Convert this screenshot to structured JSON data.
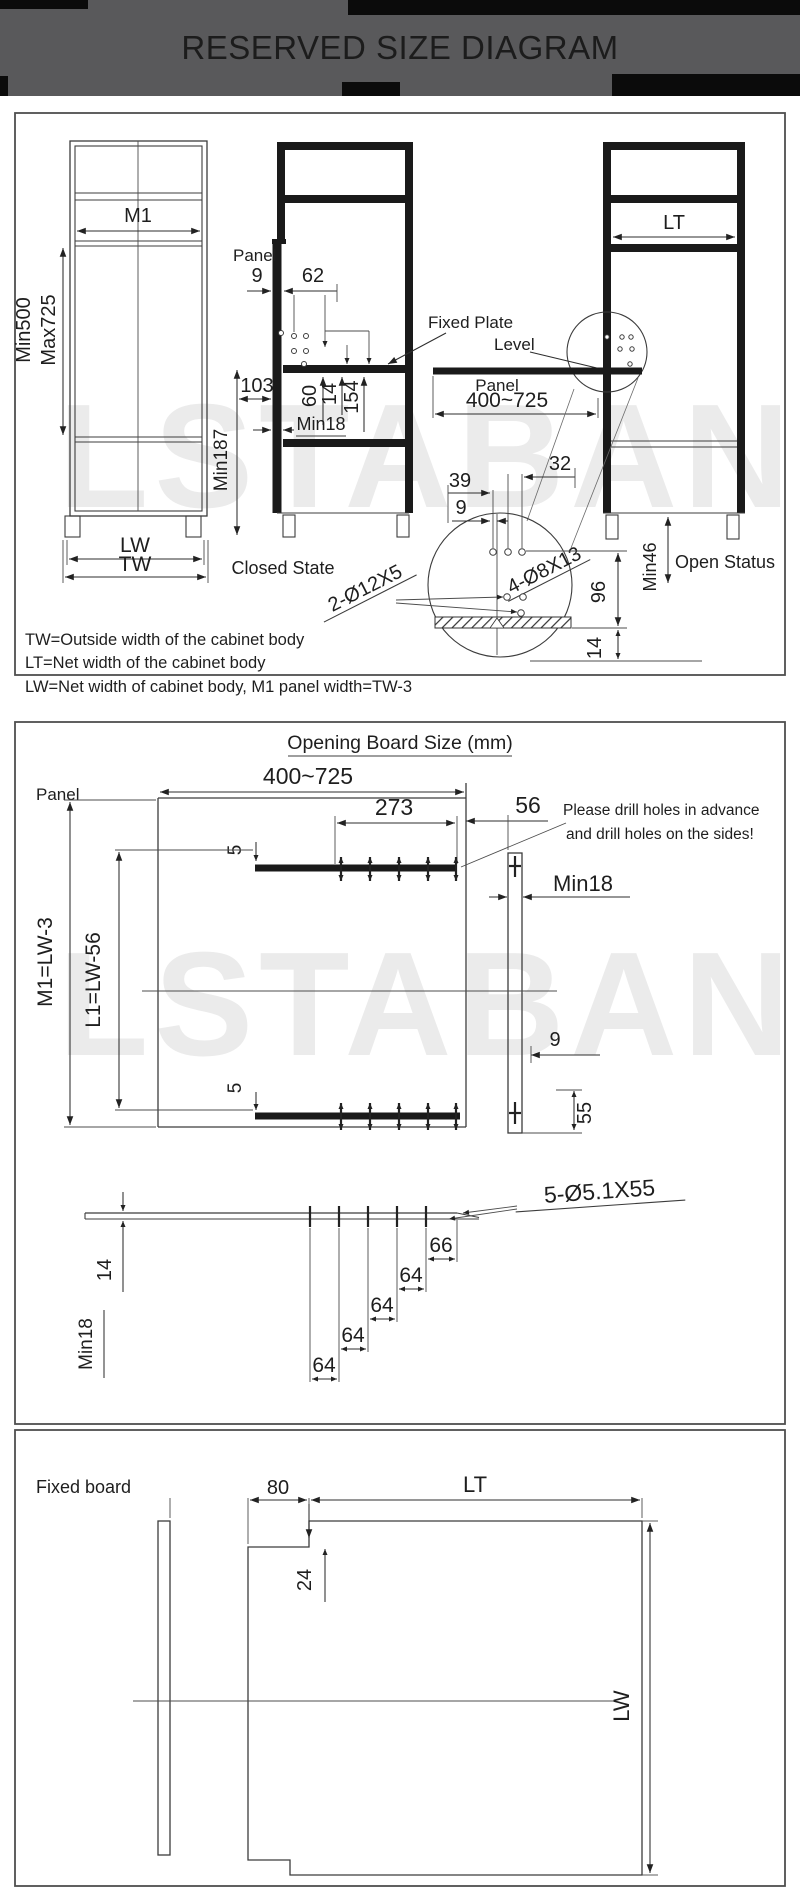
{
  "header": {
    "title": "RESERVED SIZE DIAGRAM"
  },
  "watermark": {
    "text": "LSTABAN"
  },
  "section1": {
    "m1": "M1",
    "min500": "Min500",
    "max725": "Max725",
    "panel_label": "Panel",
    "d9": "9",
    "d62": "62",
    "fixed_plate": "Fixed Plate",
    "level": "Level",
    "d103": "103",
    "d60": "60",
    "d14": "14",
    "d154": "154",
    "min18": "Min18",
    "min187": "Min187",
    "lw": "LW",
    "tw": "TW",
    "closed_state": "Closed State",
    "open_status": "Open Status",
    "lt": "LT",
    "panel2": "Panel",
    "range": "400~725",
    "d32": "32",
    "d39": "39",
    "d9b": "9",
    "holes_8x13": "4-Ø8X13",
    "holes_12x5": "2-Ø12X5",
    "d96": "96",
    "d14b": "14",
    "min46": "Min46",
    "fn1": "TW=Outside width of the cabinet body",
    "fn2": "LT=Net width of the cabinet body",
    "fn3": "LW=Net width of cabinet body, M1 panel width=TW-3"
  },
  "section2": {
    "title": "Opening Board Size (mm)",
    "panel_label": "Panel",
    "range": "400~725",
    "d273": "273",
    "d56": "56",
    "note1": "Please drill holes in advance",
    "note2": "and drill holes on the sides!",
    "d5": "5",
    "min18": "Min18",
    "m1_eq": "M1=LW-3",
    "l1_eq": "L1=LW-56",
    "d9": "9",
    "d55": "55",
    "holes": "5-Ø5.1X55",
    "d66": "66",
    "d64": "64",
    "d14": "14",
    "min18b": "Min18"
  },
  "section3": {
    "title": "Fixed board",
    "d80": "80",
    "lt": "LT",
    "d24": "24",
    "lw": "LW"
  }
}
